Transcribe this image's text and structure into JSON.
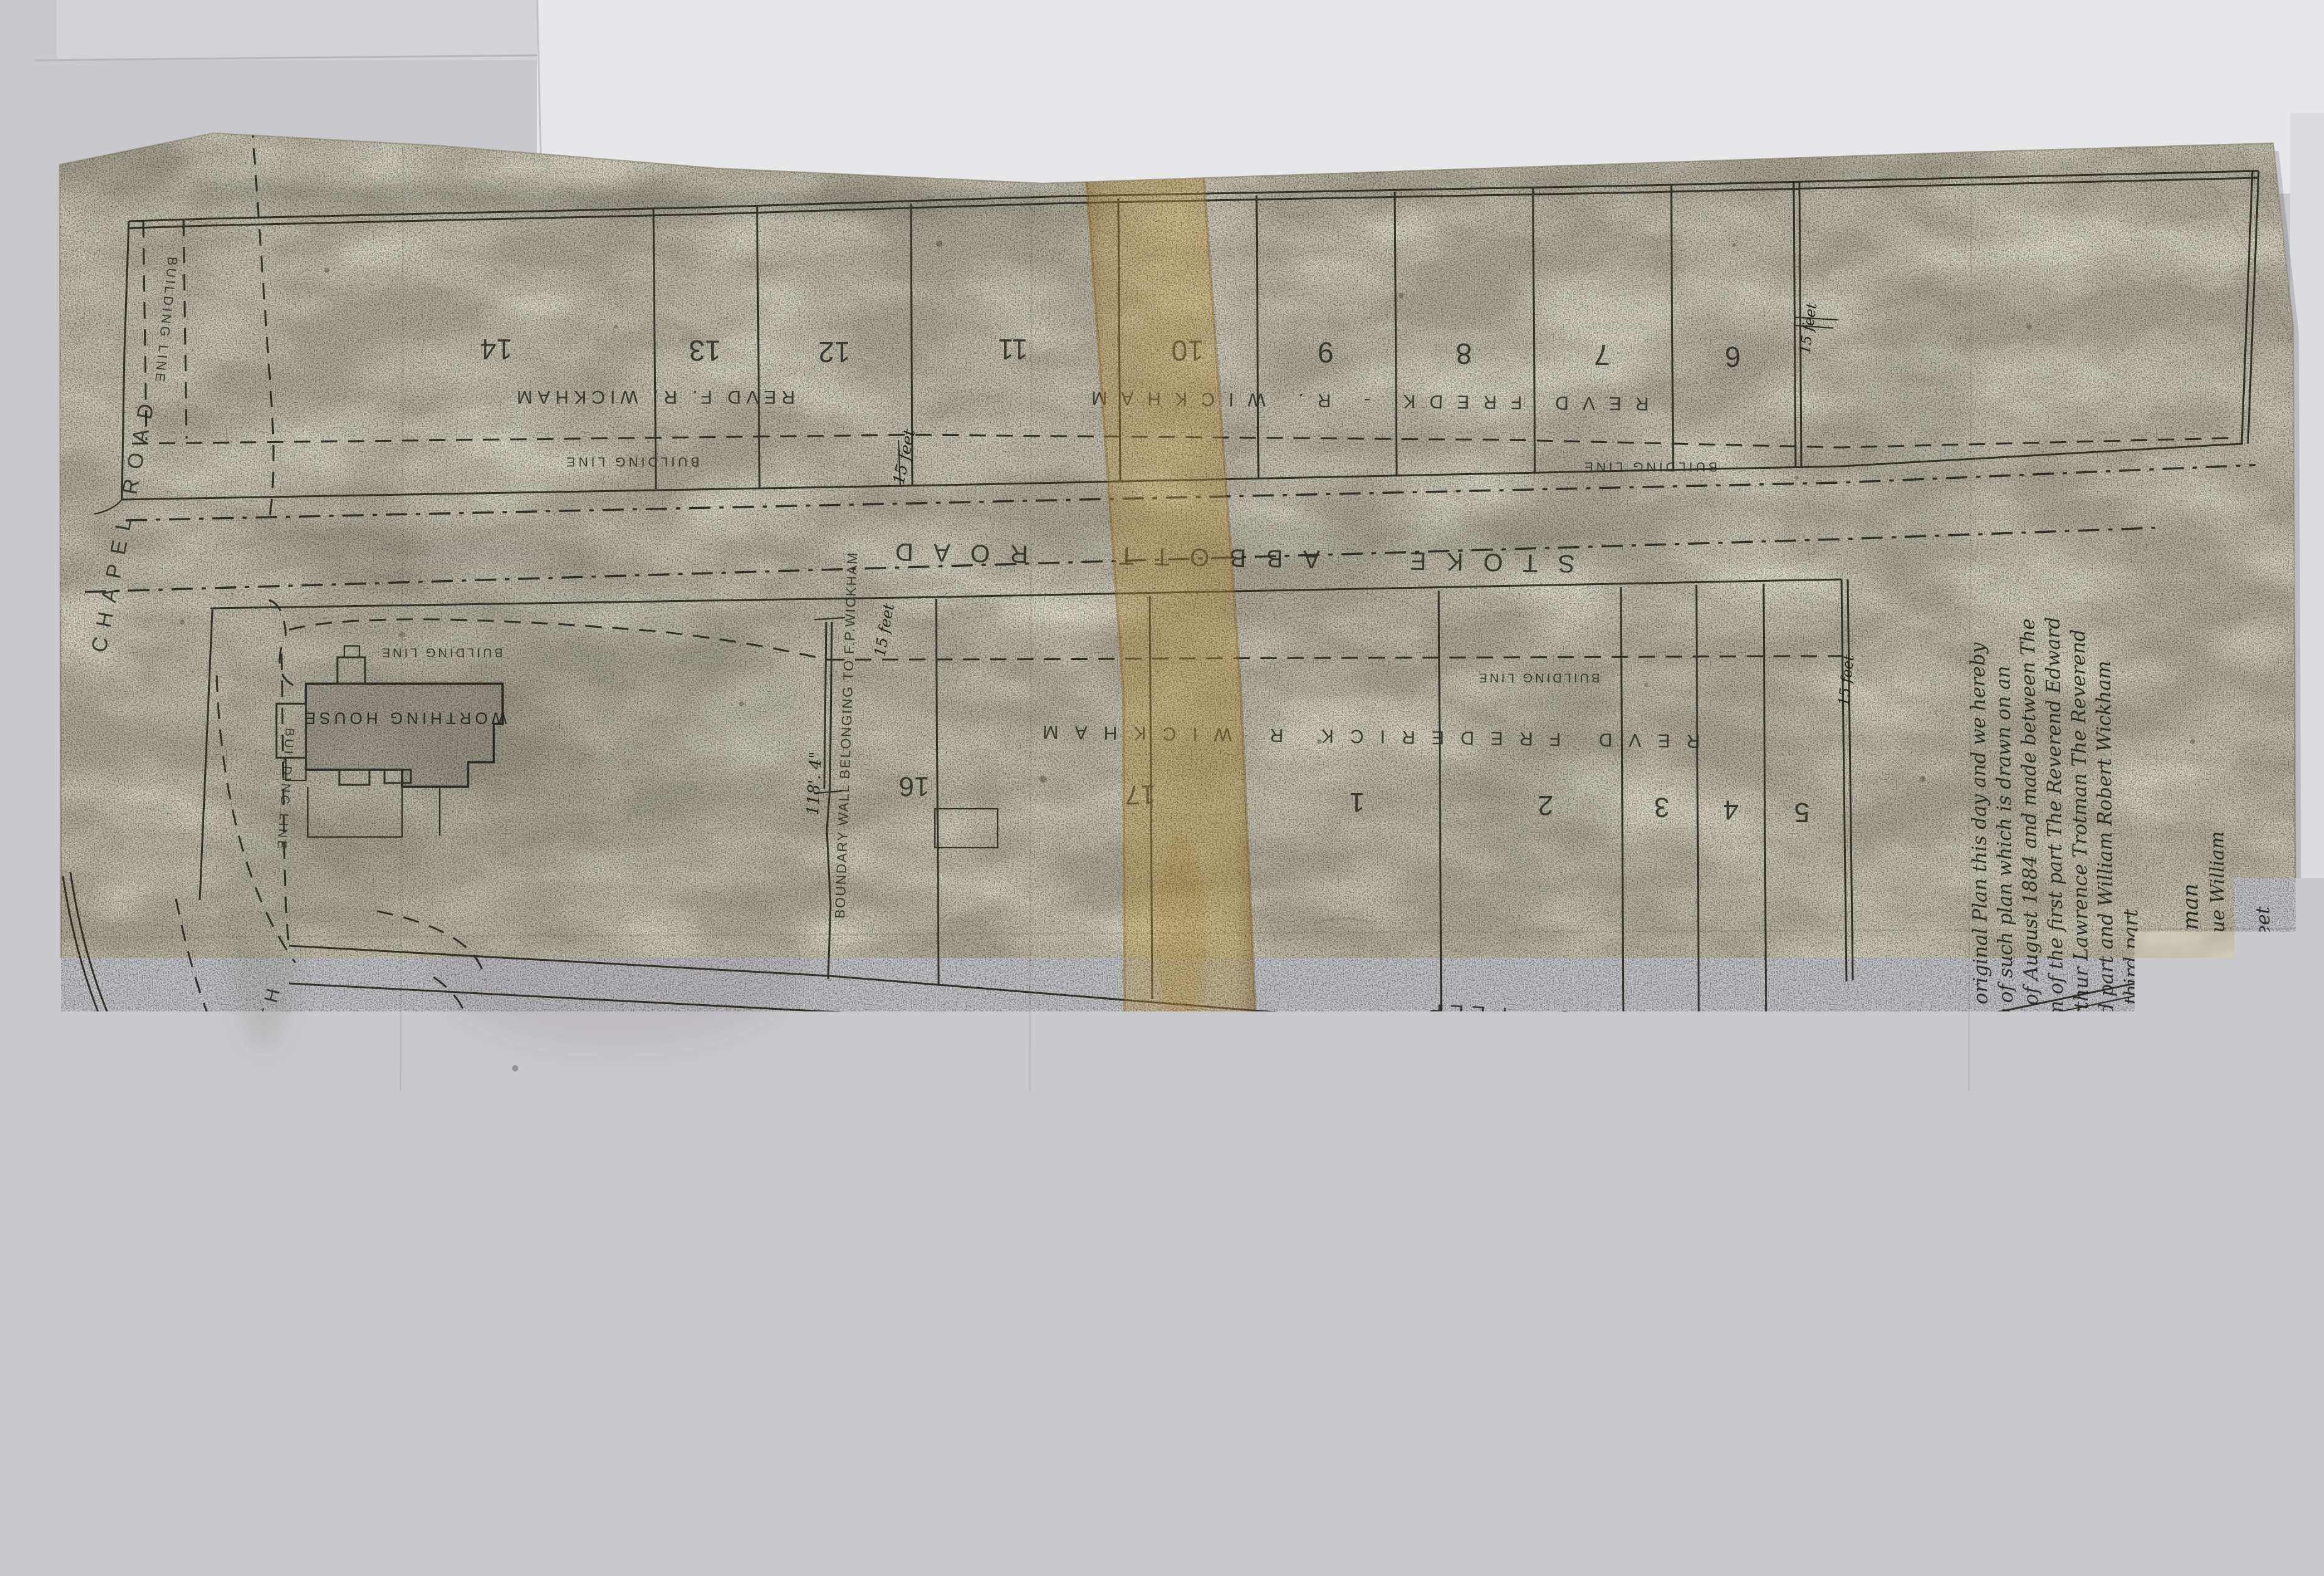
{
  "plan": {
    "roads": {
      "stoke_abbott": "STOKE ABBOTT ROAD",
      "chapel_road": "CHAPEL ROAD",
      "chapel_road_north": "CHAPEL ROAD NORTH",
      "bo_peep": "BO - PEEP",
      "lane": "LANE"
    },
    "labels": {
      "building_line": "BUILDING LINE",
      "fifteen_feet": "15 feet",
      "worthing_house": "WORTHING HOUSE",
      "boundary_wall": "BOUNDARY WALL BELONGING TO F.P.WICKHAM",
      "wall_dim": "118'. 4\"",
      "owner_top_left": "REVD F. R. WICKHAM",
      "owner_top_right": "REVD FREDK - R. WICKHAM",
      "owner_middle": "REVD FREDERICK R WICKHAM"
    },
    "top_row_plots": [
      "14",
      "13",
      "12",
      "11",
      "10",
      "9",
      "8",
      "7",
      "6"
    ],
    "middle_row_plots": [
      "16",
      "17",
      "1",
      "2",
      "3",
      "4",
      "5"
    ],
    "stamp": {
      "word1": "ONE",
      "word2": "SHILLING"
    }
  },
  "annotation": {
    "lines": [
      "4 August 1891. Examined with the original Plan this day and we hereby",
      "declare the same to be a true copy of such plan which is drawn on an",
      "Indenture bearing date the 18 day of August 1884 and made between The",
      "Reverend Frederick Tiers Wickham of the first part The Reverend Edward",
      "Fiennes Trotman The Reverend Arthur Lawrence Trotman The Reverend",
      "Henry John Wickham of the second part and William Robert Wickham",
      "and Ellen Wickham his Wife of the third part"
    ],
    "signature_1": "Wm H. Banch",
    "signature_2": "Wm A. Blakman",
    "clerks_line": "Clerks to Mr H. Montague William",
    "role": "Solicitor",
    "address": "17 Middle Street",
    "town": "Brighton"
  }
}
